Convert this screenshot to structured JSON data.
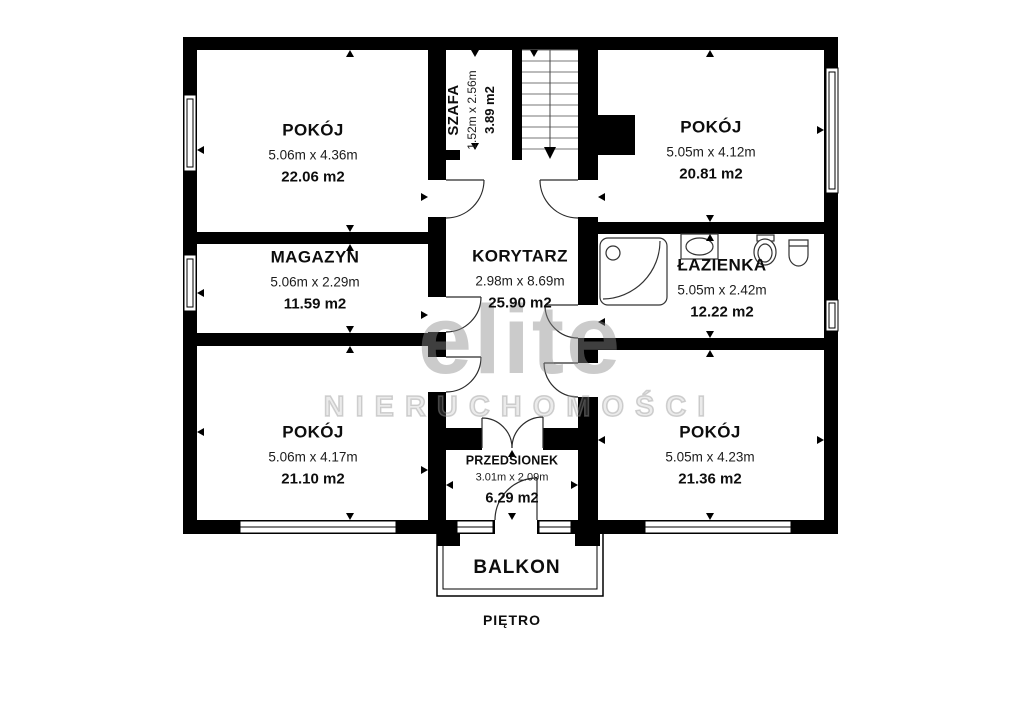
{
  "plan": {
    "floor_label": "PIĘTRO",
    "balcony_label": "BALKON",
    "rooms": [
      {
        "key": "pokoj-top-left",
        "name": "POKÓJ",
        "dims": "5.06m x 4.36m",
        "area": "22.06 m2"
      },
      {
        "key": "szafa",
        "name": "SZAFA",
        "dims": "1.52m x 2.56m",
        "area": "3.89 m2"
      },
      {
        "key": "pokoj-top-right",
        "name": "POKÓJ",
        "dims": "5.05m x 4.12m",
        "area": "20.81 m2"
      },
      {
        "key": "magazyn",
        "name": "MAGAZYN",
        "dims": "5.06m x 2.29m",
        "area": "11.59 m2"
      },
      {
        "key": "korytarz",
        "name": "KORYTARZ",
        "dims": "2.98m x 8.69m",
        "area": "25.90 m2"
      },
      {
        "key": "lazienka",
        "name": "ŁAZIENKA",
        "dims": "5.05m x 2.42m",
        "area": "12.22 m2"
      },
      {
        "key": "pokoj-bottom-left",
        "name": "POKÓJ",
        "dims": "5.06m x 4.17m",
        "area": "21.10 m2"
      },
      {
        "key": "przedsionek",
        "name": "PRZEDSIONEK",
        "dims": "3.01m x 2.09m",
        "area": "6.29 m2"
      },
      {
        "key": "pokoj-bottom-right",
        "name": "POKÓJ",
        "dims": "5.05m x 4.23m",
        "area": "21.36 m2"
      }
    ],
    "watermark": {
      "brand": "elite",
      "subtitle": "NIERUCHOMOŚCI"
    },
    "colors": {
      "wall": "#000000",
      "background": "#ffffff",
      "fixture_stroke": "#333333",
      "watermark": "#8c8c8c"
    }
  }
}
